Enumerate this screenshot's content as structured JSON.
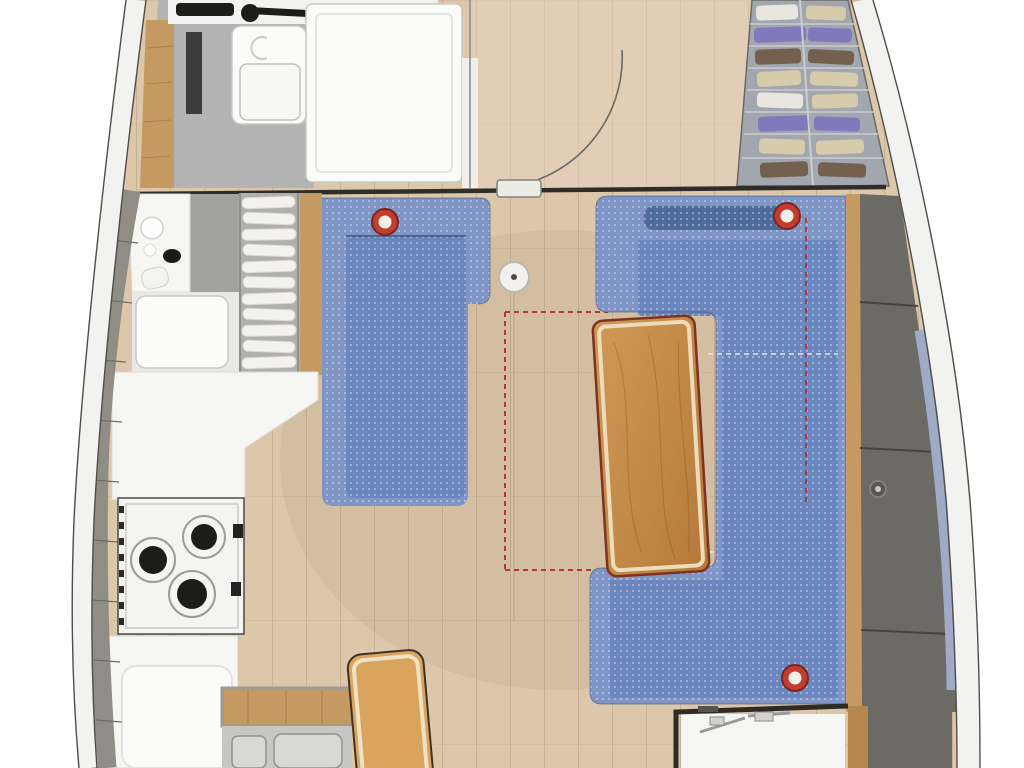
{
  "meta": {
    "description": "Top-down interior floor plan of a sailboat saloon: head and shower forward-port, hanging wardrobe forward-starboard, linear galley with 3-burner stove and double sink to port, chaise settee to port, U-shaped settee with fixed wooden table to starboard, companionway step aft, aft cabin partially visible",
    "canvas": {
      "width": 1024,
      "height": 768
    },
    "visible_text": []
  },
  "legend": {
    "head_compartment": "shower stall, vanity and counter, forward port",
    "wardrobe": "slatted shelves with folded clothes, forward starboard",
    "door": "quarter-circle swing door at forward bulkhead",
    "galley": "counter, cooktop with three burners, double sink, dish rack",
    "port_settee": "blue upholstered chaise settee with speaker",
    "starboard_settee": "blue U-shaped settee with two speakers and berth-conversion dashed outline",
    "saloon_table": "wooden table with fold-out extension shown as red dashed outline",
    "mast_post": "compression post in saloon centreline",
    "companionway_step": "wooden step aft of galley",
    "aft_cabin": "partially visible aft cabin with white berth"
  },
  "colors": {
    "page_bg": "#ffffff",
    "floor_wood": "#dcc7ab",
    "floor_plank_line": "#c8b193",
    "floor_fore": "#e8d6c4",
    "hull_band": "#f2f2f0",
    "hull_line": "#504e49",
    "deck_tile": "#8f8d86",
    "deck_blue": "#a9b4cf",
    "deck_blue_right": "#9fabc6",
    "bulkhead": "#2f2d29",
    "settee_blue": "#7e95c5",
    "settee_seat": "#6a86bd",
    "settee_bolster": "#4f6b9d",
    "settee_seam": "#40557e",
    "speaker_ring": "#c23d31",
    "speaker_rim": "#7e241c",
    "speaker_center": "#f3efe6",
    "table_wood_light": "#cf9a55",
    "table_wood_dark": "#b5793a",
    "table_border": "#ecdcbc",
    "table_outline": "#7e3320",
    "bench_wood": "#d9a45e",
    "bench_border": "#efe2c4",
    "bench_outline": "#3f3226",
    "trim_wood": "#c49a62",
    "cushion_grey": "#6b6a64",
    "cushion_seam": "#45443f",
    "counter_white": "#f6f6f3",
    "counter_edge": "#d8d8d4",
    "counter_grey": "#a2a2a0",
    "head_floor": "#b3b3b3",
    "fixture_white": "#fbfbfa",
    "fixture_line": "#c9c9c6",
    "dark_counter": "#2f2f2d",
    "faucet_black": "#1c1c1a",
    "stove_white": "#f4f4f2",
    "stove_outline": "#4a4a46",
    "burner_black": "#1c1c1a",
    "burner_ring": "#9a9a96",
    "sink_steel": "#c6c6c3",
    "sink_basin": "#d8d8d5",
    "sink_basin_edge": "#90908c",
    "slat_bg": "#b0b0ae",
    "slat_white": "#f3f2ef",
    "wardrobe_bg": "#a2a6ae",
    "wardrobe_line": "#caccd0",
    "clothes_beige": "#d6cbaa",
    "clothes_brown": "#74604e",
    "clothes_purple": "#8279bd",
    "clothes_white": "#e8e6df",
    "door_arc": "#6b6b66",
    "dash_red": "#b33a2c",
    "dash_white": "#e8e8ea",
    "mast_fill": "#f2f1ed",
    "mast_edge": "#b9b8b2",
    "aft_frame": "#2e2a24",
    "aft_white": "#f6f6f4",
    "aft_wood": "#b5854e",
    "hardware_grey": "#9a9a96"
  }
}
